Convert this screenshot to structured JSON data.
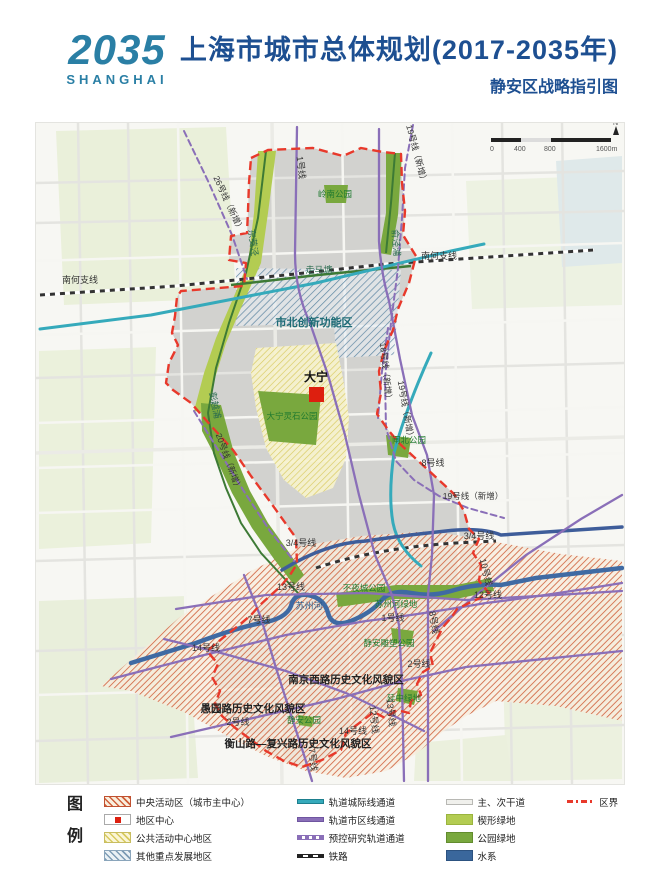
{
  "header": {
    "logo_line1": "2035",
    "logo_line2": "SHANGHAI",
    "title": "上海市城市总体规划(2017-2035年)",
    "subtitle": "静安区战略指引图"
  },
  "map": {
    "scale": {
      "ticks": [
        "0",
        "400",
        "800",
        "1600m"
      ],
      "north": "N"
    },
    "labels": {
      "line_1_north": "1号线",
      "line_19_new_ne": "19号线（新增）",
      "line_26_new": "26号线（新增）",
      "river_dongjiaojing": "东茭泾",
      "park_lingnan": "岭南公园",
      "river_yujingpu": "俞泾浦",
      "rail_nanhe_west": "南何支线",
      "rail_nanhe_east": "南何支线",
      "river_zoumatang": "走马塘",
      "area_shibei": "市北创新功能区",
      "river_pengyuepu": "彭越浦",
      "line_18_new": "18号线（新增）",
      "line_19_new_mid": "19号线（新增）",
      "center_daning": "大宁",
      "line_20_new": "20号线（新增）",
      "park_daning_lingshi": "大宁灵石公园",
      "park_zhabei": "闸北公园",
      "line_8_mid": "8号线",
      "line_19_new_s": "19号线（新增）",
      "line_34_west": "3/4号线",
      "line_34_east": "3/4号线",
      "line_13_west": "13号线",
      "line_10": "10号线",
      "line_12_east": "12号线",
      "park_buyecheng": "不夜城公园",
      "river_suzhou": "苏州河",
      "green_suzhou": "苏州河绿地",
      "line_1_south": "1号线",
      "line_8_south": "8号线",
      "line_7_west": "7号线",
      "line_14_west": "14号线",
      "park_jingan_sculpture": "静安雕塑公园",
      "line_2_east": "2号线",
      "area_nanjing_west_road": "南京西路历史文化风貌区",
      "green_yanzhong": "延中绿地",
      "area_yuyuan_road": "愚园路历史文化风貌区",
      "park_jingan": "静安公园",
      "line_2_west": "2号线",
      "line_12_south": "12号线",
      "line_13_south": "13号线",
      "line_14_south": "14号线",
      "area_hengshan_fuxing": "衡山路—复兴路历史文化风貌区",
      "line_7_south": "7号线"
    }
  },
  "legend": {
    "title": "图例",
    "groups": [
      {
        "items": [
          {
            "swatch": "hatch-orange",
            "label": "中央活动区（城市主中心）"
          },
          {
            "swatch": "red-square",
            "label": "地区中心"
          },
          {
            "swatch": "hatch-yellow",
            "label": "公共活动中心地区"
          },
          {
            "swatch": "hatch-blue",
            "label": "其他重点发展地区"
          }
        ]
      },
      {
        "items": [
          {
            "swatch": "line-teal",
            "label": "轨道城际线通道"
          },
          {
            "swatch": "line-purple",
            "label": "轨道市区线通道"
          },
          {
            "swatch": "line-purple-dash",
            "label": "预控研究轨道通道"
          },
          {
            "swatch": "line-rail",
            "label": "铁路"
          }
        ]
      },
      {
        "items": [
          {
            "swatch": "line-road",
            "label": "主、次干道"
          },
          {
            "swatch": "fill-wedge-green",
            "label": "楔形绿地"
          },
          {
            "swatch": "fill-park-green",
            "label": "公园绿地"
          },
          {
            "swatch": "fill-water",
            "label": "水系"
          }
        ]
      },
      {
        "items": [
          {
            "swatch": "line-boundary",
            "label": "区界"
          }
        ]
      }
    ]
  },
  "colors": {
    "brand_teal": "#2a7fa5",
    "title_navy": "#1d4f91",
    "boundary_red": "#e8392b",
    "intercity_teal": "#35aabb",
    "metro_purple": "#8a6fb8",
    "line34_blue": "#3e5d9a",
    "water_blue": "#3f6aa3",
    "park_green": "#79a83e",
    "wedge_green": "#b3cc52",
    "cad_hatch_orange": "#cf5f3a",
    "district_gray": "#d2d2cf"
  }
}
